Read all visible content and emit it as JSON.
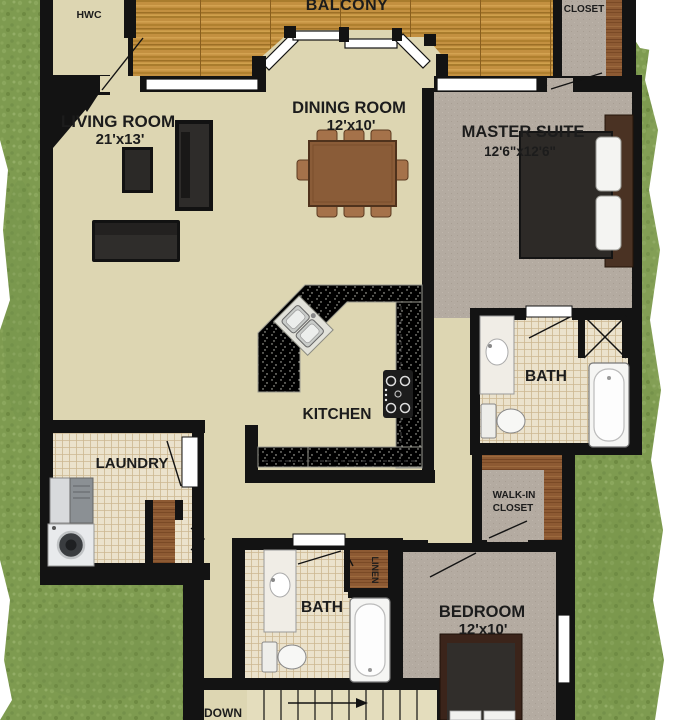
{
  "plan": {
    "rooms": {
      "balcony": {
        "name": "BALCONY"
      },
      "hwc": {
        "name": "HWC"
      },
      "living": {
        "name": "LIVING ROOM",
        "dims": "21'x13'"
      },
      "dining": {
        "name": "DINING ROOM",
        "dims": "12'x10'"
      },
      "master": {
        "name": "MASTER SUITE",
        "dims": "12'6\"x12'6\""
      },
      "closet": {
        "name": "CLOSET"
      },
      "bath_main": {
        "name": "BATH"
      },
      "kitchen": {
        "name": "KITCHEN"
      },
      "laundry": {
        "name": "LAUNDRY"
      },
      "walk_in": {
        "name": "WALK-IN",
        "name2": "CLOSET"
      },
      "bath_second": {
        "name": "BATH"
      },
      "linen": {
        "name": "LINEN"
      },
      "bedroom": {
        "name": "BEDROOM",
        "dims": "12'x10'"
      },
      "stairs": {
        "name": "DOWN"
      }
    },
    "colors": {
      "wall": "#131313",
      "floor_cream": "#ddd6b2",
      "carpet_taupe": "#b4aba1",
      "deck_wood": "#c39040",
      "wood_brown": "#8d5a33",
      "tile": "#ebe2cc",
      "grass": "#7e9b50",
      "counter": "#ededе7",
      "fixture_white": "#f5f5f3",
      "furniture_dark": "#2e2c29"
    }
  }
}
